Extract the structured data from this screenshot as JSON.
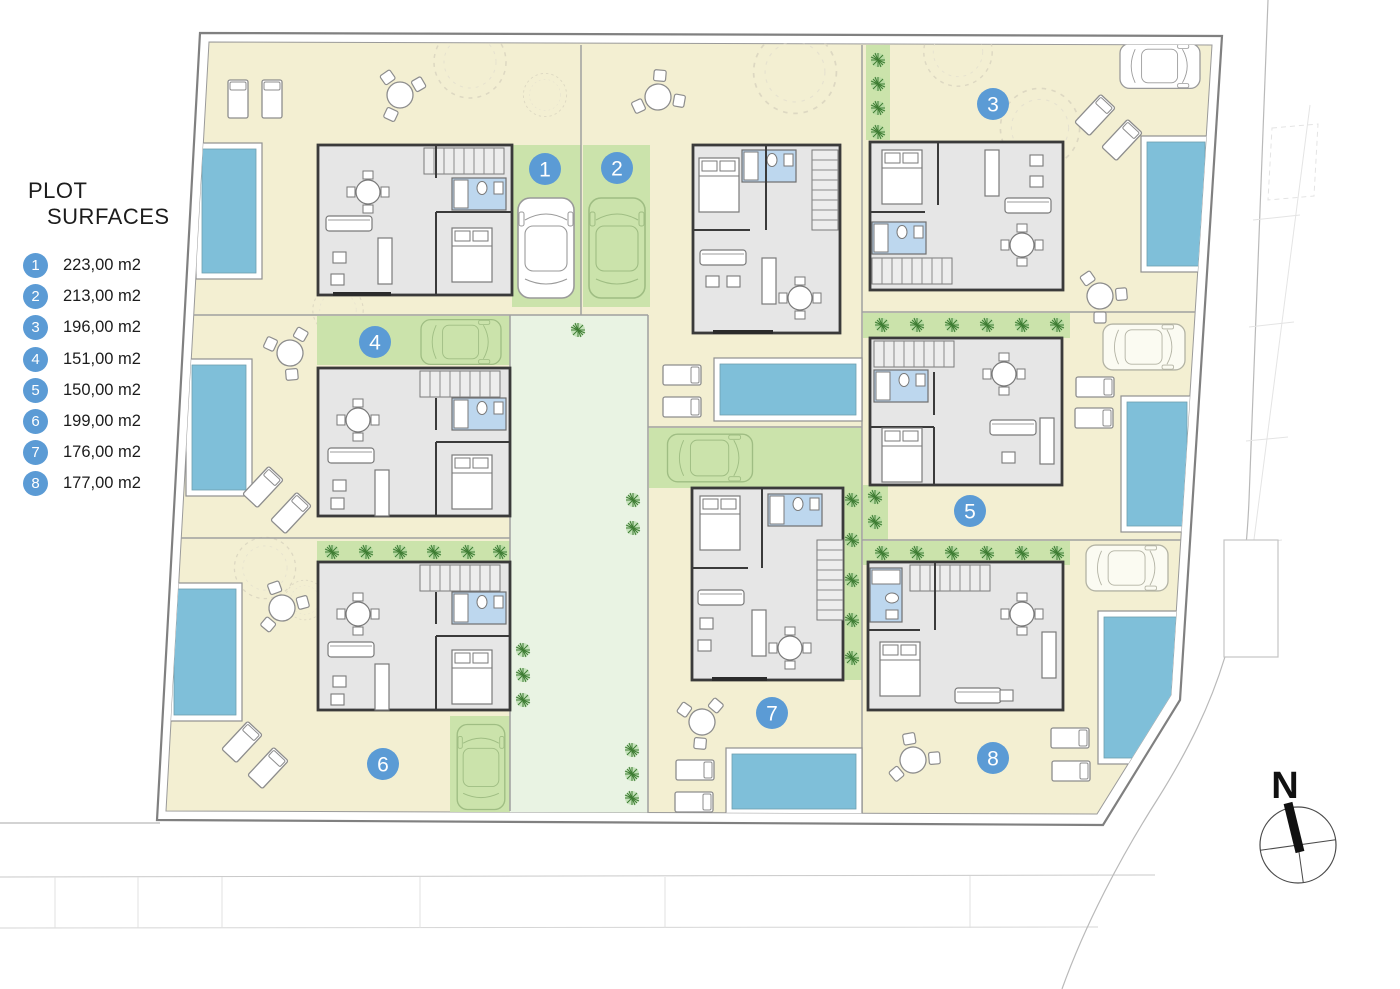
{
  "legend": {
    "title_line1": "PLOT",
    "title_line2": "SURFACES",
    "items": [
      {
        "number": "1",
        "area": "223,00 m2"
      },
      {
        "number": "2",
        "area": "213,00 m2"
      },
      {
        "number": "3",
        "area": "196,00 m2"
      },
      {
        "number": "4",
        "area": "151,00 m2"
      },
      {
        "number": "5",
        "area": "150,00 m2"
      },
      {
        "number": "6",
        "area": "199,00 m2"
      },
      {
        "number": "7",
        "area": "176,00 m2"
      },
      {
        "number": "8",
        "area": "177,00 m2"
      }
    ]
  },
  "compass": {
    "label": "N"
  },
  "colors": {
    "badge_blue": "#5b9bd5",
    "plot_cream": "#f3efd2",
    "green_strip": "#cbe3ab",
    "walkway_pale_green": "#e9f3e3",
    "pool_blue": "#7fbfd9",
    "bathroom_blue": "#bdd7ee",
    "house_wall": "#3a3a3a"
  }
}
